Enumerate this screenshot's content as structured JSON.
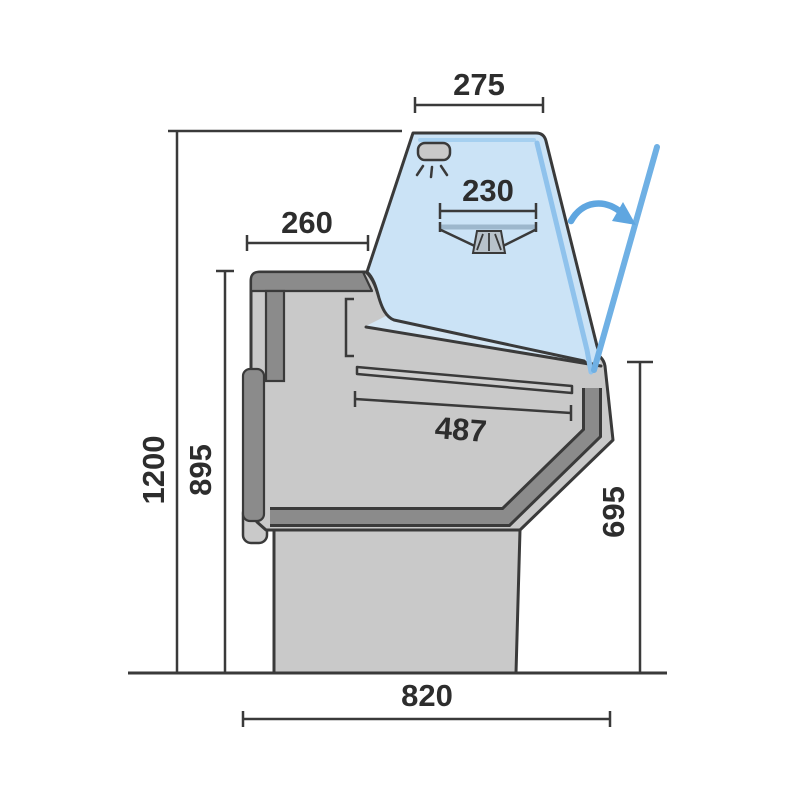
{
  "diagram": {
    "subject": "refrigerated-serve-over-counter-side-section",
    "dimensions": {
      "top_width": "275",
      "canopy_shelf_width": "230",
      "rear_top_depth": "260",
      "display_deck_length": "487",
      "overall_height": "1200",
      "worktop_height": "895",
      "front_height": "695",
      "base_depth": "820"
    },
    "icons": {
      "lamp": "canopy-light-icon",
      "swing_arrow": "glass-opening-arrow"
    },
    "colors": {
      "outline": "#3a3a3a",
      "body_gray": "#c9c9c9",
      "trim_gray": "#8b8b8b",
      "glass_blue": "#cbe3f6",
      "glass_highlight": "#8fc2ec",
      "accent_blue": "#5fa6e0",
      "label": "#2d2d2d",
      "background": "#ffffff"
    }
  }
}
